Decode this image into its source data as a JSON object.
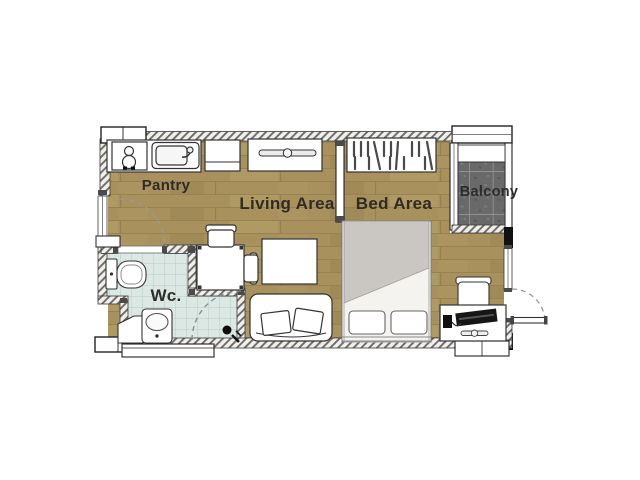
{
  "page": {
    "description": "Studio condominium unit floor plan"
  },
  "plan": {
    "rooms": {
      "pantry": {
        "label": "Pantry"
      },
      "living": {
        "label": "Living Area"
      },
      "bed": {
        "label": "Bed Area"
      },
      "balcony": {
        "label": "Balcony"
      },
      "wc": {
        "label": "Wc."
      }
    },
    "colors": {
      "wood_floor": "#a8915c",
      "wood_grain": "#8d7a4d",
      "wc_tile": "#dbe8e4",
      "wc_tile_grid": "#b7cdc9",
      "balcony_tile": "#696969",
      "balcony_grout": "#9c9c9c",
      "wall_fill": "#f0efec",
      "wall_hatch": "#6e6c68",
      "duvet": "#cac7c2",
      "label_text": "#2f2b27"
    },
    "fixtures": [
      "stove",
      "kitchen-sink",
      "pantry-cabinet",
      "tv-console",
      "wardrobe",
      "dining-table",
      "dining-chairs",
      "coffee-table",
      "sofa",
      "double-bed",
      "desk",
      "desk-chair",
      "computer",
      "toilet",
      "wash-basin",
      "shower",
      "floor-drain",
      "entrance-door",
      "wc-door",
      "balcony-window",
      "air-condenser"
    ]
  }
}
